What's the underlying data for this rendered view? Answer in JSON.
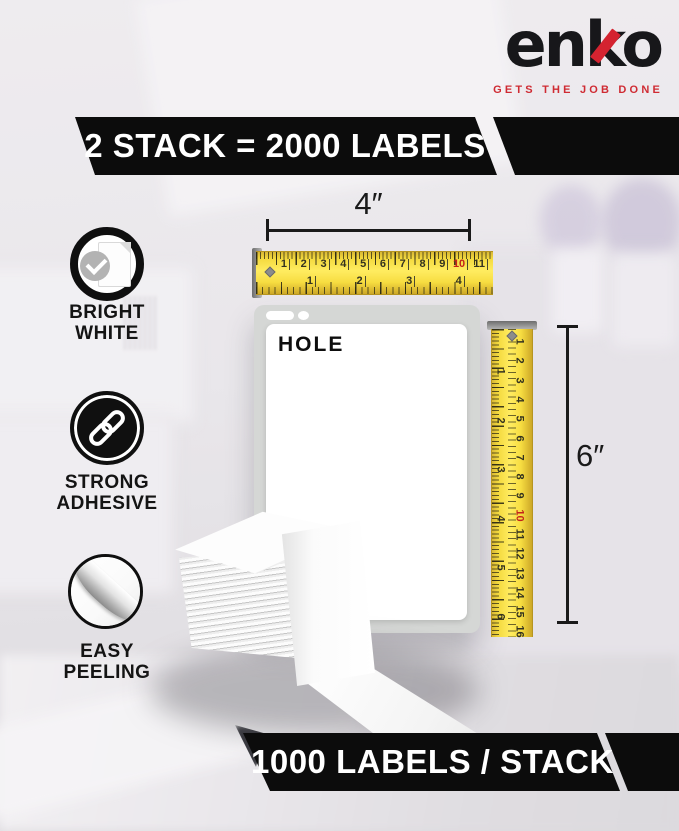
{
  "brand": {
    "name": "enko",
    "tagline": "GETS THE JOB DONE"
  },
  "banners": {
    "top": "2 STACK = 2000 LABELS",
    "bottom": "1000 LABELS / STACK"
  },
  "features": [
    {
      "icon": "paper-check-icon",
      "line1": "BRIGHT",
      "line2": "WHITE"
    },
    {
      "icon": "chain-link-icon",
      "line1": "STRONG",
      "line2": "ADHESIVE"
    },
    {
      "icon": "peeling-label-icon",
      "line1": "EASY",
      "line2": "PEELING"
    }
  ],
  "label_sheet": {
    "corner_text": "HOLE"
  },
  "measurements": {
    "width": "4″",
    "height": "6″"
  },
  "rulers": {
    "horizontal": {
      "cm_numbers": [
        "1",
        "2",
        "3",
        "4",
        "5",
        "6",
        "7",
        "8",
        "9",
        "10",
        "11"
      ],
      "inch_numbers": [
        "1",
        "2",
        "3",
        "4"
      ],
      "red_number": "10"
    },
    "vertical": {
      "cm_numbers": [
        "1",
        "2",
        "3",
        "4",
        "5",
        "6",
        "7",
        "8",
        "9",
        "10",
        "11",
        "12",
        "13",
        "14",
        "15",
        "16"
      ],
      "inch_numbers": [
        "1",
        "2",
        "3",
        "4",
        "5",
        "6"
      ],
      "red_number": "10"
    }
  },
  "colors": {
    "accent_red": "#d42330",
    "banner_black": "#0c0c0c",
    "tape_yellow": "#ffec60"
  }
}
